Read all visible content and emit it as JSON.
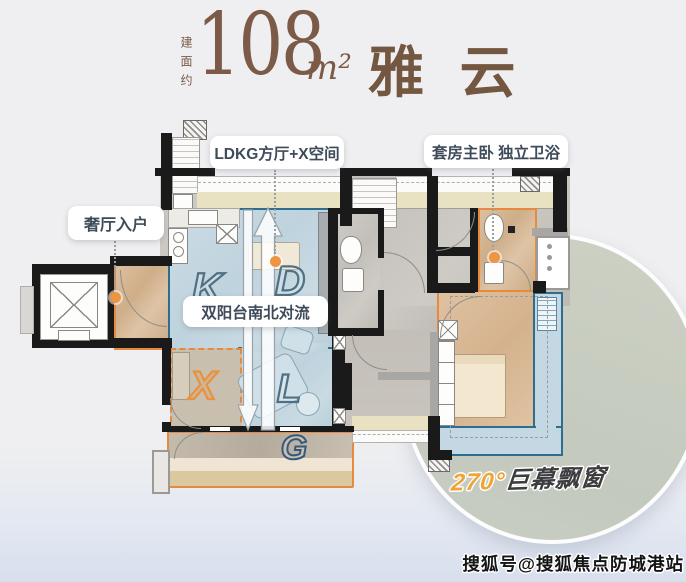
{
  "page": {
    "watermark": "搜狐号@搜狐焦点防城港站",
    "background_color": "#efeff1"
  },
  "title": {
    "area_prefix": "建面约",
    "area_value": "108",
    "area_unit": "m²",
    "plan_name": "雅 云",
    "color": "#7b5b48"
  },
  "callouts": {
    "entry": "奢厅入户",
    "hall": "LDKG方厅+X空间",
    "suite": "套房主卧 独立卫浴",
    "airflow": "双阳台南北对流"
  },
  "bay_window": {
    "degree": "270°",
    "label": "巨幕飘窗",
    "degree_color": "#f0a437"
  },
  "floorplan": {
    "rooms": [
      {
        "letter": "K",
        "name": "kitchen"
      },
      {
        "letter": "D",
        "name": "dining"
      },
      {
        "letter": "L",
        "name": "living"
      },
      {
        "letter": "X",
        "name": "flex-space"
      },
      {
        "letter": "G",
        "name": "south-balcony"
      }
    ],
    "colors": {
      "highlight_blue_border": "#2f6d8e",
      "highlight_orange_border": "#e58a3f",
      "marker_dot": "#ef9440",
      "circle_fill": "#c8ccbf"
    }
  }
}
